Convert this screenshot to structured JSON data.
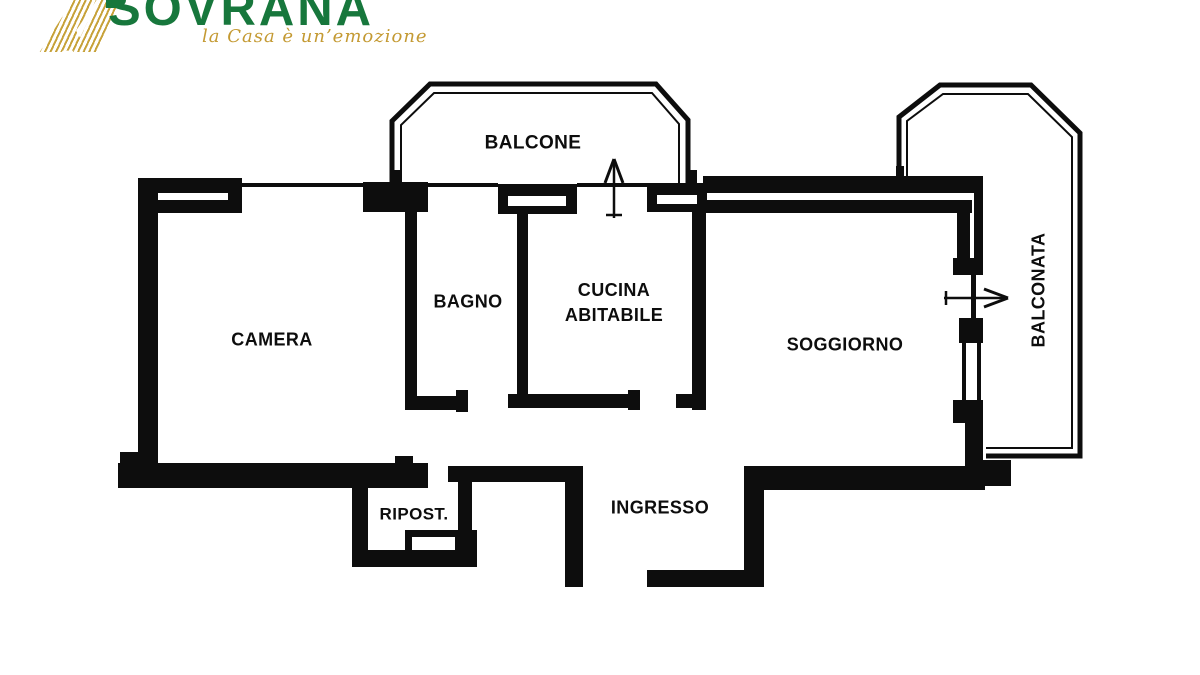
{
  "brand": {
    "name": "SOVRANA",
    "tagline": "la Casa è un’emozione",
    "brand_green": "#17773c",
    "brand_gold": "#c7a23a"
  },
  "floorplan": {
    "ink_color": "#0d0d0d",
    "rooms": {
      "balcone": "BALCONE",
      "camera": "CAMERA",
      "bagno": "BAGNO",
      "cucina_line1": "CUCINA",
      "cucina_line2": "ABITABILE",
      "soggiorno": "SOGGIORNO",
      "balconata": "BALCONATA",
      "ripost": "RIPOST.",
      "ingresso": "INGRESSO"
    }
  }
}
